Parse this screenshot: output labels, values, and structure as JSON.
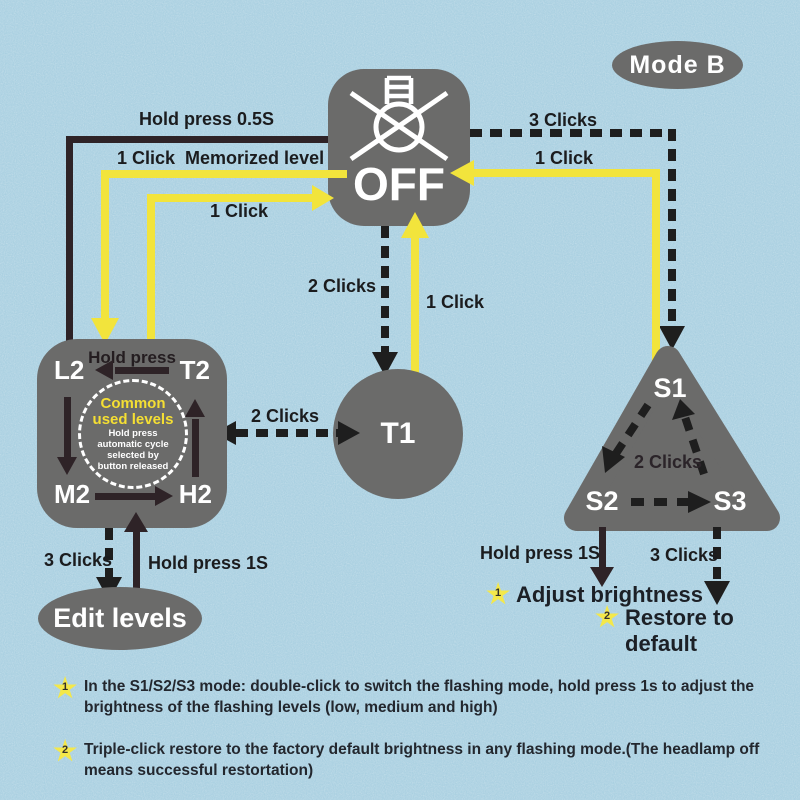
{
  "mode_badge": "Mode B",
  "icons": {
    "star": "★"
  },
  "nodes": {
    "off": "OFF",
    "t1": "T1",
    "edit_levels": "Edit levels",
    "levels": {
      "l2": "L2",
      "t2": "T2",
      "m2": "M2",
      "h2": "H2",
      "hold_press": "Hold press",
      "center_title": [
        "Common",
        "used levels"
      ],
      "center_note": [
        "Hold press",
        "automatic cycle",
        "selected by",
        "button released"
      ]
    },
    "flash": {
      "s1": "S1",
      "s2": "S2",
      "s3": "S3",
      "center_label": "2 Clicks"
    }
  },
  "labels": {
    "hold_press_05s": "Hold press 0.5S",
    "one_click_memorized": "1 Click  Memorized level",
    "one_click_to_off_left": "1 Click",
    "two_clicks_off_to_t1": "2 Clicks",
    "one_click_t1_to_off": "1 Click",
    "two_clicks_levels_t1": "2 Clicks",
    "three_clicks_off_to_s1": "3 Clicks",
    "one_click_s1_to_off": "1 Click",
    "three_clicks_to_edit": "3 Clicks",
    "hold_press_1s_to_levels": "Hold press 1S",
    "hold_press_1s_s2": "Hold press 1S",
    "three_clicks_s3": "3 Clicks"
  },
  "outcomes": {
    "adjust": {
      "badge": "1",
      "label": "Adjust brightness"
    },
    "restore": {
      "badge": "2",
      "label": "Restore to default"
    }
  },
  "notes": [
    {
      "badge": "1",
      "lines": [
        "In the S1/S2/S3 mode: double-click to switch the flashing mode, hold press 1s to adjust the",
        "brightness of the flashing levels (low, medium and high)"
      ]
    },
    {
      "badge": "2",
      "lines": [
        "Triple-click restore to the factory default brightness in any flashing mode.(The headlamp off",
        "means successful restortation)"
      ]
    }
  ],
  "colors": {
    "background": "#a6cee0",
    "node_gray": "#6b6b6a",
    "accent_yellow": "#f2e43c",
    "arrow_dark": "#2e2327",
    "dash_black": "#1e1e1e",
    "star_yellow": "#f4e84a",
    "label_dark": "#1b1c1e",
    "circle_title_yellow": "#f5df33"
  }
}
